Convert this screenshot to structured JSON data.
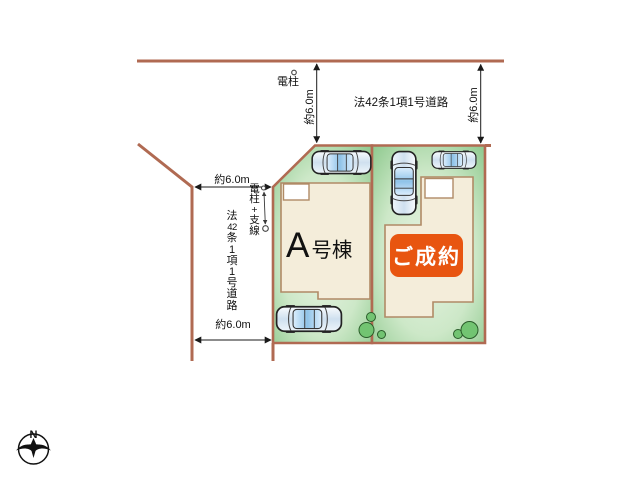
{
  "plan": {
    "road_label_top": "法42条1項1号道路",
    "road_label_left_chars": [
      "法",
      "42",
      "条",
      "1",
      "項",
      "1",
      "号",
      "道",
      "路"
    ],
    "pole_label": "電柱",
    "pole_guy_label_chars": [
      "電",
      "柱",
      "+",
      "支",
      "線"
    ],
    "dims": {
      "top_road_left": "約6.0m",
      "top_road_right": "約6.0m",
      "left_road_top": "約6.0m",
      "left_road_bottom": "約6.0m"
    },
    "lot_a": {
      "name_main": "A",
      "name_suffix": "号棟"
    },
    "lot_b": {
      "badge": "ご成約"
    },
    "compass_north": "N",
    "colors": {
      "road_line": "#b06a52",
      "lot_green_dark": "#8cc88c",
      "lot_green_light": "#e8f4e3",
      "building_fill": "#f4edda",
      "building_outline": "#b08a66",
      "badge_bg": "#e85510",
      "badge_text": "#ffffff",
      "dim_line": "#1a1a1a"
    }
  }
}
